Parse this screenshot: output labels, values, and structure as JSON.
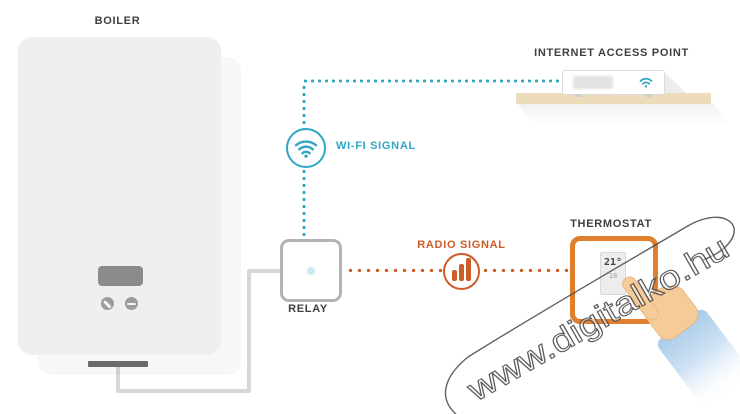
{
  "nodes": {
    "boiler": {
      "label": "BOILER"
    },
    "relay": {
      "label": "RELAY"
    },
    "thermostat": {
      "label": "THERMOSTAT",
      "display": {
        "current_temp": "21°",
        "setpoint": "18"
      }
    },
    "internet_access_point": {
      "label": "INTERNET ACCESS POINT"
    }
  },
  "links": {
    "wifi": {
      "label": "WI-FI SIGNAL",
      "color": "#2ea6c4",
      "icon": "wifi-icon",
      "style": "dotted"
    },
    "radio": {
      "label": "RADIO SIGNAL",
      "color": "#cd5c28",
      "icon": "radio-bars-icon",
      "style": "dotted"
    },
    "wire": {
      "color": "#d7d7d8"
    }
  },
  "watermark": {
    "text": "www.digitalko.hu"
  },
  "colors": {
    "wifi_accent": "#2ea6c4",
    "radio_accent": "#cd5c28",
    "thermostat_border": "#e0802f",
    "shelf": "#ecdcba",
    "boiler_body": "#efeff0",
    "sleeve_blue": "#a9cbe9",
    "skin": "#f5cb97"
  }
}
